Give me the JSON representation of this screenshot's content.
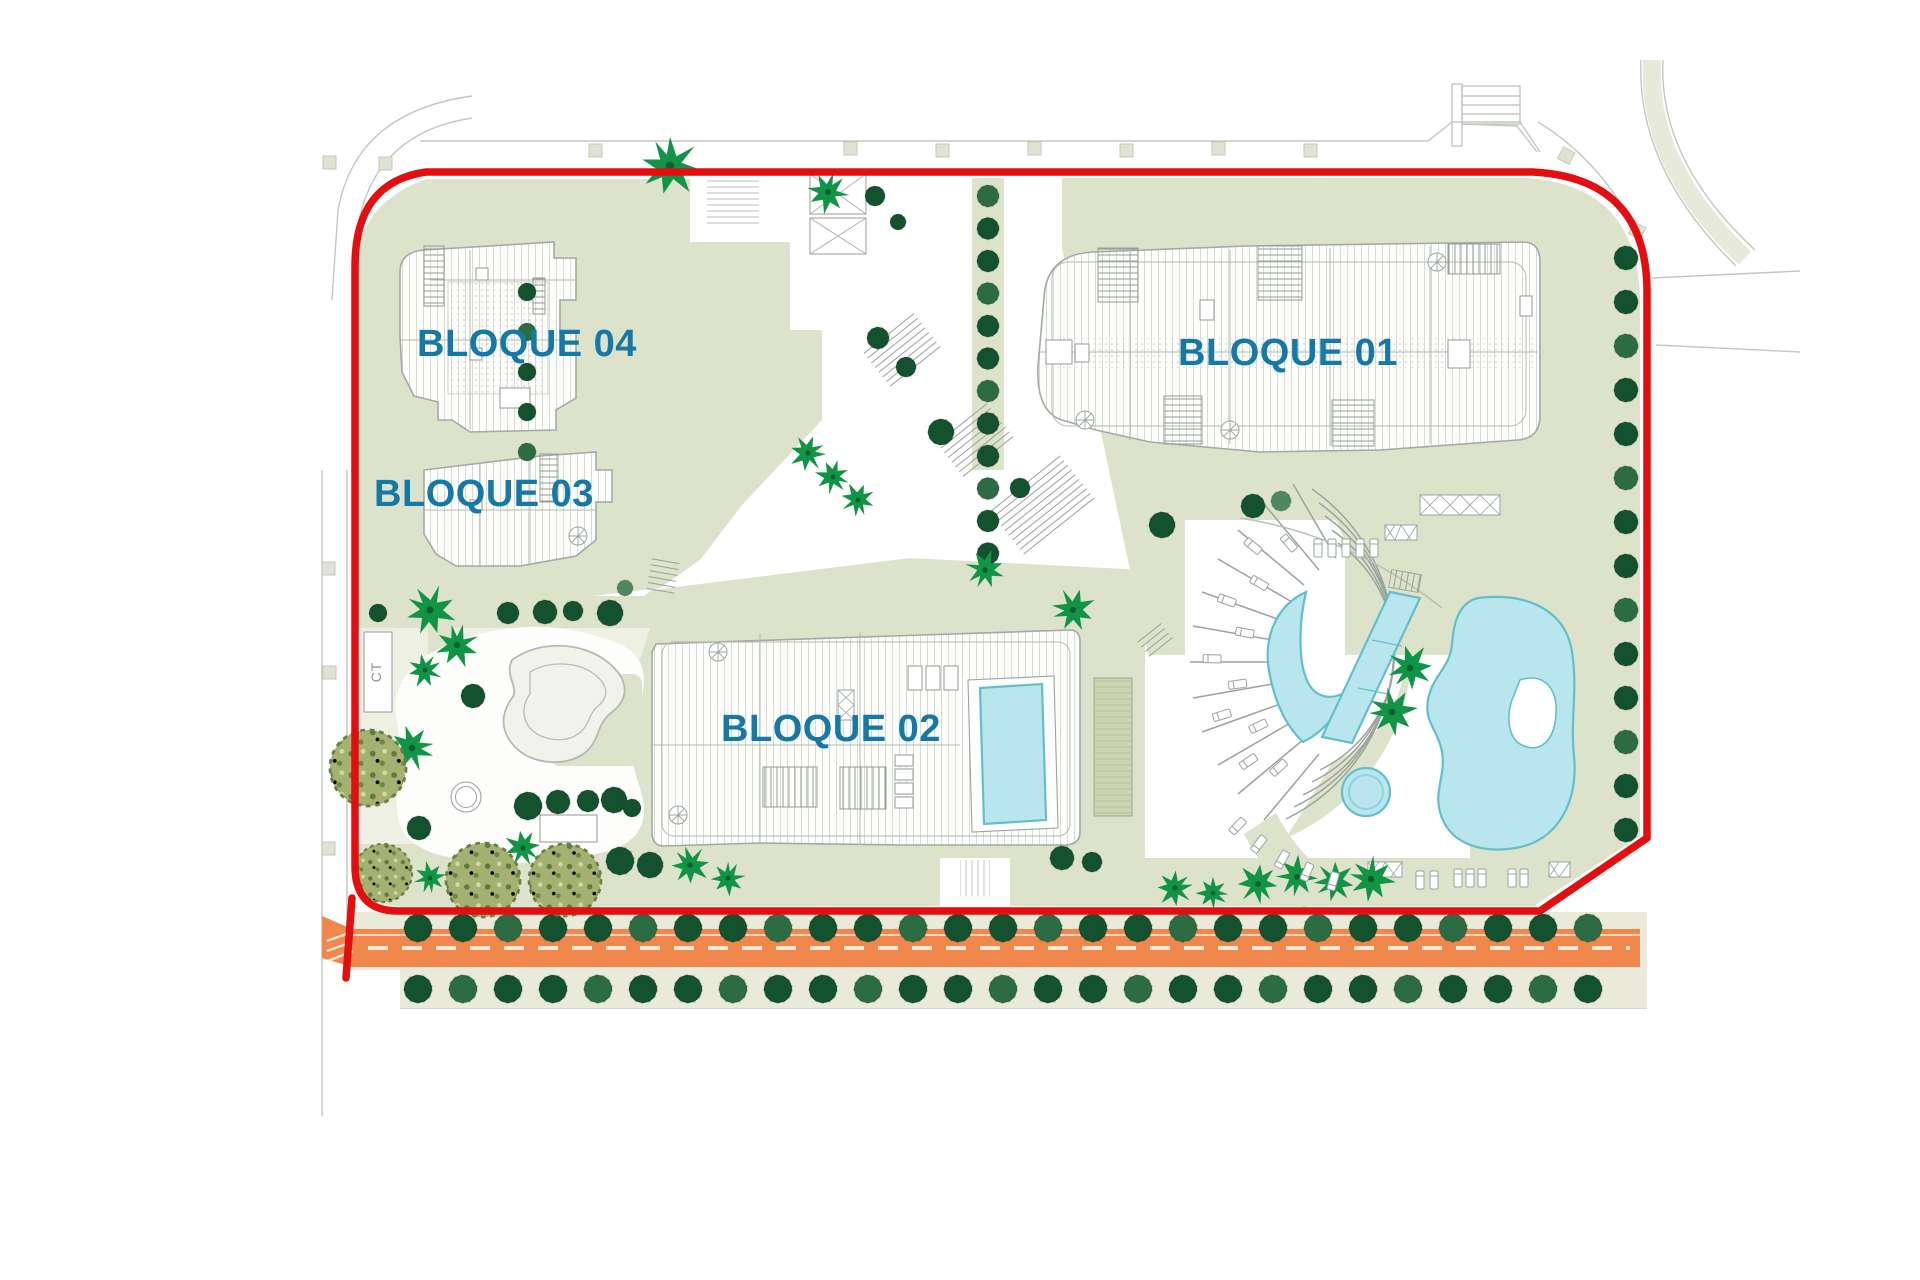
{
  "type": "architectural-site-plan",
  "blocks": [
    {
      "id": "bloque-01",
      "label": "BLOQUE 01"
    },
    {
      "id": "bloque-02",
      "label": "BLOQUE 02"
    },
    {
      "id": "bloque-03",
      "label": "BLOQUE 03"
    },
    {
      "id": "bloque-04",
      "label": "BLOQUE 04"
    }
  ],
  "labels": {
    "ct": "CT"
  },
  "features": {
    "boundary": "red perimeter line of plot",
    "road": "orange street with dashed centerline along south edge",
    "pools": [
      "crescent pool",
      "lap pool",
      "lagoon pool",
      "round spa pool",
      "rooftop pool on bloque 02"
    ],
    "amphitheater": "curved terraced steps facing pool plaza",
    "vegetation": [
      "street trees",
      "palm trees",
      "olive trees"
    ]
  },
  "colors": {
    "boundary": "#e30e10",
    "road": "#f0874d",
    "road_dash": "#fbe7d2",
    "pool": "#b9e6ee",
    "pool_edge": "#62bfca",
    "sage": "#dde2cb",
    "sage_light": "#eef0e3",
    "beige": "#e9ead9",
    "tree_dark": "#14512e",
    "tree_mid": "#2d6b42",
    "tree_light": "#4f8763",
    "palm": "#129447",
    "olive": "#a5b171",
    "label_blue": "#1578a6",
    "building_line": "#a2aaa4",
    "hatch_line": "#d6dbd4",
    "line_gray": "#c2c8c0"
  }
}
